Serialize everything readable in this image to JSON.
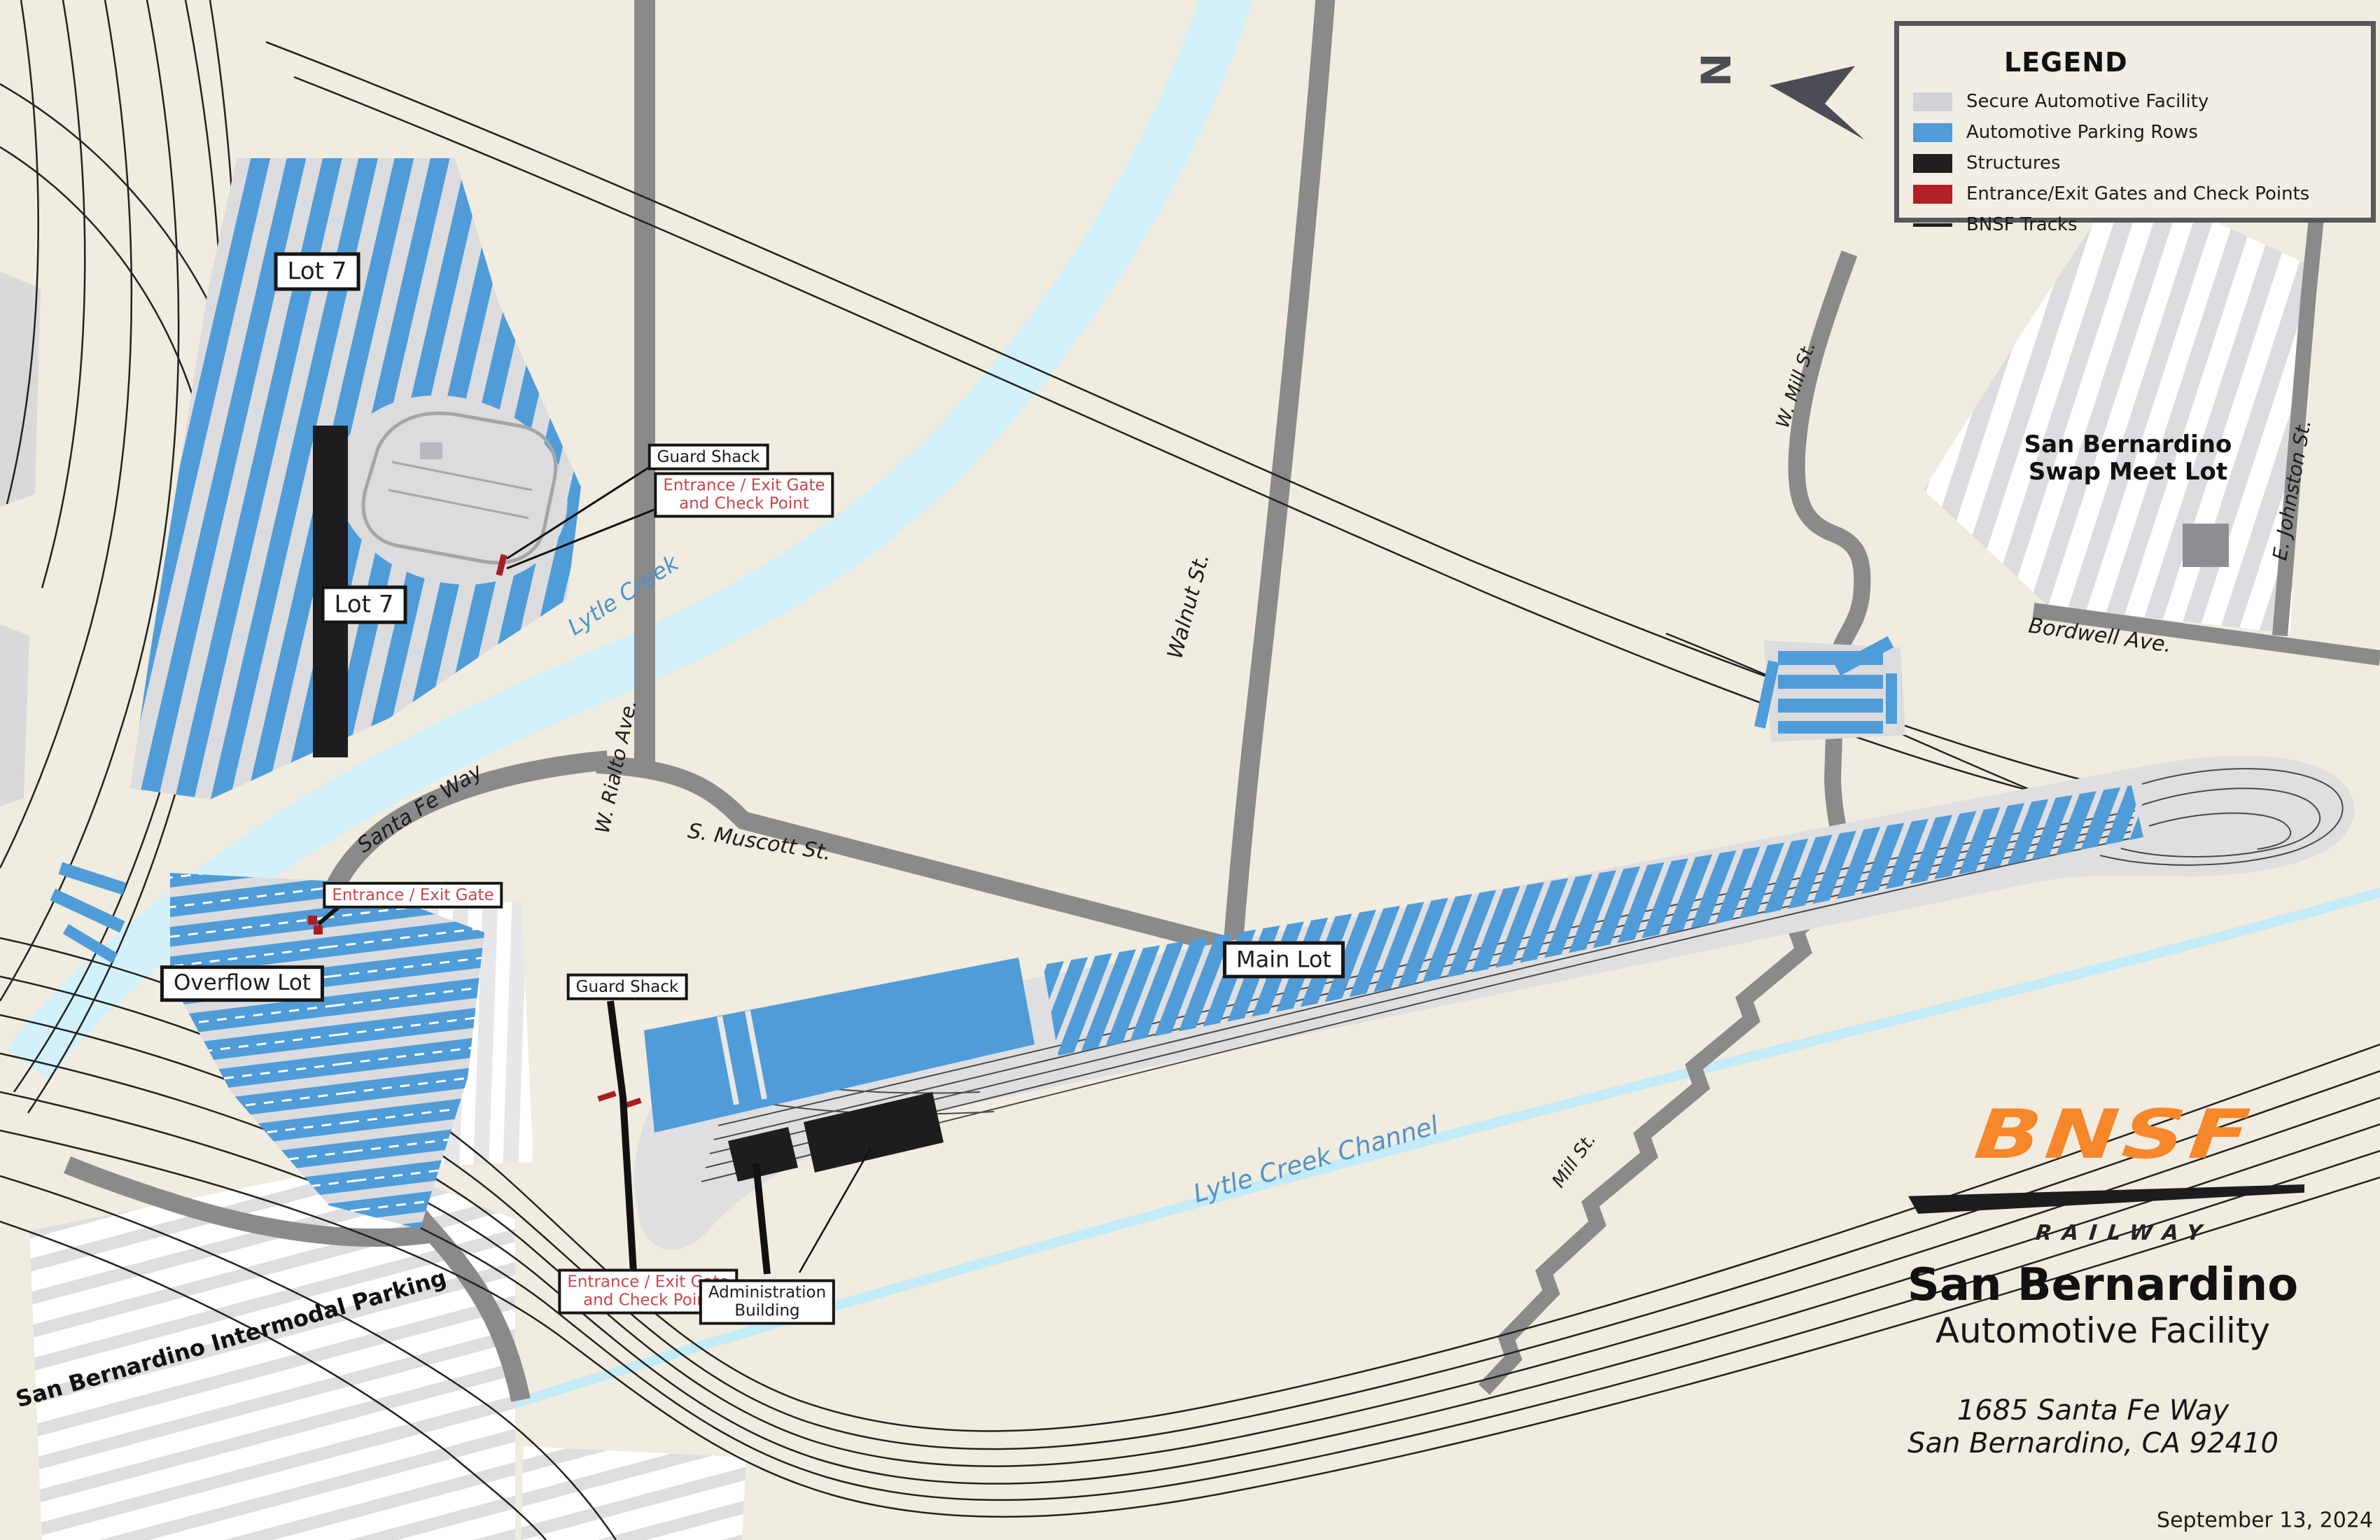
{
  "legend": {
    "title": "LEGEND",
    "items": [
      {
        "label": "Secure Automotive Facility",
        "color": "#d2d3d8",
        "type": "fill"
      },
      {
        "label": "Automotive Parking Rows",
        "color": "#4f9cd8",
        "type": "fill"
      },
      {
        "label": "Structures",
        "color": "#231f20",
        "type": "fill"
      },
      {
        "label": "Entrance/Exit Gates and Check Points",
        "color": "#b32025",
        "type": "fill"
      },
      {
        "label": "BNSF Tracks",
        "color": "#231f20",
        "type": "line"
      }
    ]
  },
  "north": {
    "label": "N"
  },
  "labels": {
    "lot7_upper": "Lot 7",
    "lot7_lower": "Lot 7",
    "guard_shack_north": "Guard Shack",
    "guard_shack_main": "Guard Shack",
    "gate_checkpoint_line1": "Entrance / Exit Gate",
    "gate_checkpoint_line2": "and Check Point",
    "entrance_exit_gate": "Entrance / Exit Gate",
    "overflow_lot": "Overflow Lot",
    "main_lot": "Main Lot",
    "admin_line1": "Administration",
    "admin_line2": "Building",
    "swap_meet_line1": "San Bernardino",
    "swap_meet_line2": "Swap Meet Lot",
    "intermodal": "San Bernardino Intermodal Parking"
  },
  "streets": {
    "lytle_creek": "Lytle Creek",
    "lytle_creek_channel": "Lytle Creek Channel",
    "santa_fe_way": "Santa Fe Way",
    "w_rialto": "W. Rialto Ave.",
    "s_muscott": "S. Muscott St.",
    "walnut": "Walnut St.",
    "w_mill": "W. Mill St.",
    "bordwell": "Bordwell Ave.",
    "e_johnston": "E. Johnston St.",
    "mill": "Mill St."
  },
  "branding": {
    "logo_text": "BNSF",
    "logo_sub": "RAILWAY",
    "facility_city": "San Bernardino",
    "facility_type": "Automotive Facility",
    "address_line1": "1685 Santa Fe Way",
    "address_line2": "San Bernardino, CA 92410",
    "date": "September 13, 2024"
  },
  "colors": {
    "background": "#f0ecdf",
    "secure_facility": "#dcdcdf",
    "parking_rows": "#4f9cd8",
    "structures": "#1d1d1f",
    "gates": "#a81e24",
    "roads": "#8a8a8b",
    "creek": "#d2f1fb",
    "tracks": "#222222",
    "logo_orange": "#f6872a",
    "red_label_text": "#c8474d",
    "creek_label_text": "#4f93c9"
  }
}
